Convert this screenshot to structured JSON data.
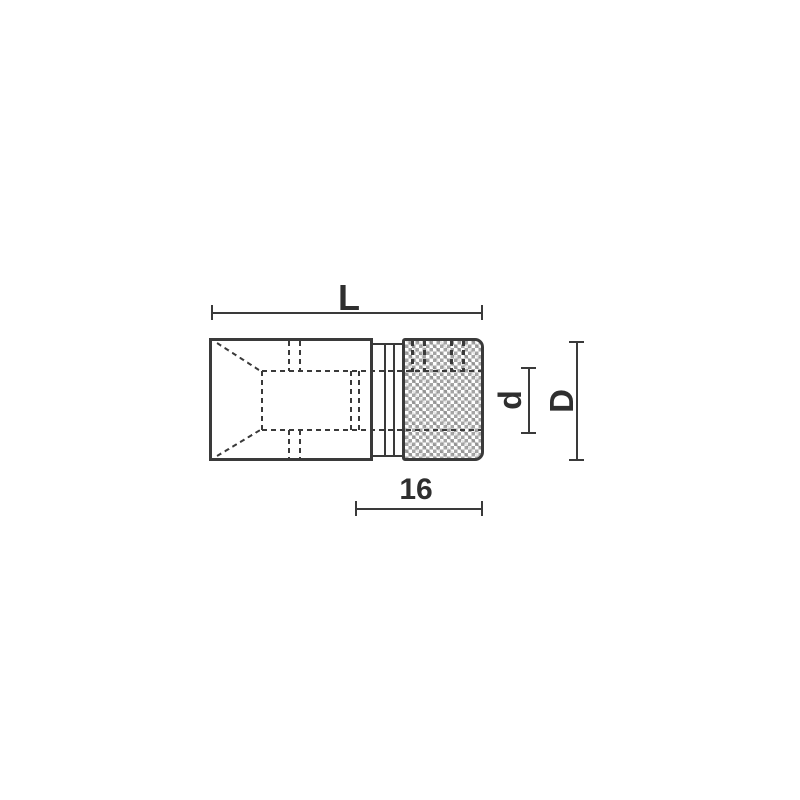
{
  "diagram": {
    "type": "technical-dimension-drawing",
    "subject": "socket adapter side view with hidden lines and knurled band",
    "labels": {
      "overall_length": "L",
      "insert_length": "16",
      "inner_diameter": "d",
      "outer_diameter": "D"
    },
    "colors": {
      "ink": "#3a3a3a",
      "knurl_gray": "#a5a5a5",
      "background": "#ffffff"
    }
  }
}
